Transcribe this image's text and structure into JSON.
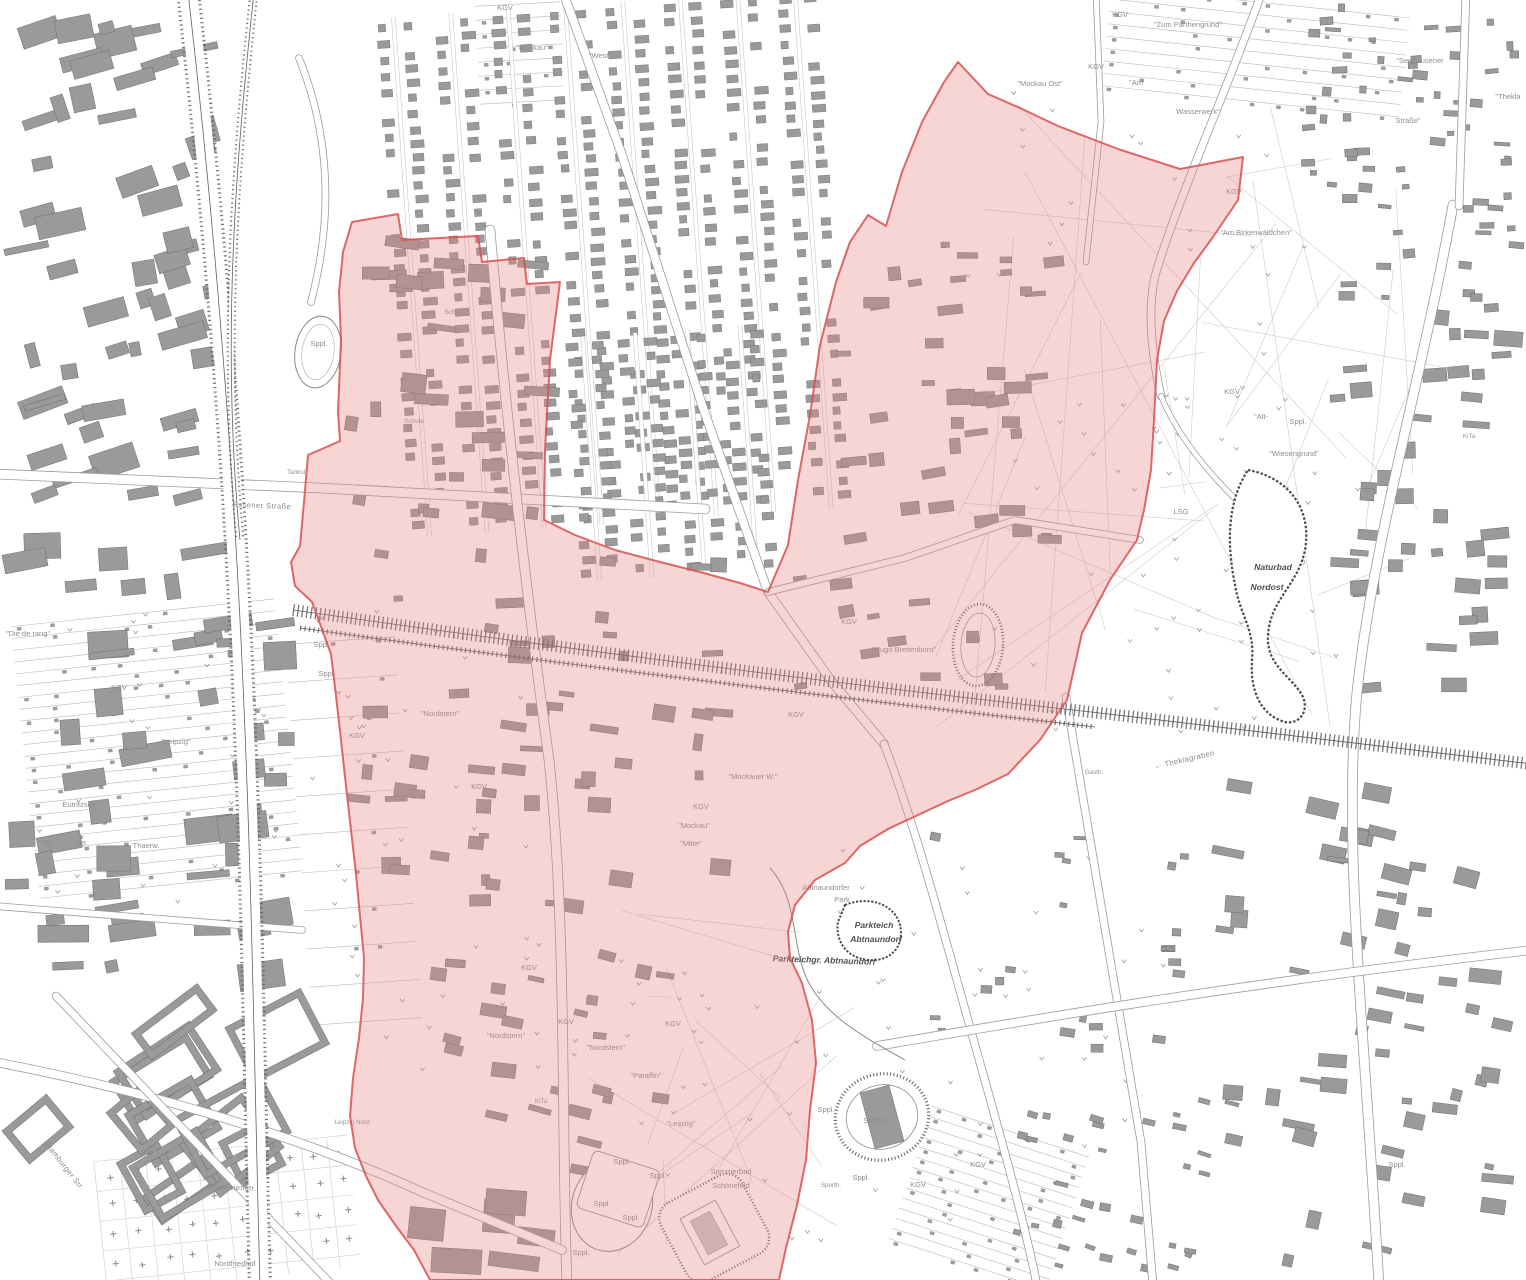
{
  "map": {
    "type": "cadastral-city-map-with-highlighted-district",
    "colors": {
      "background": "#ffffff",
      "building_fill": "#9a9a9a",
      "building_outline": "#6e6e6e",
      "road_casing": "#9c9c9c",
      "rail": "#5f5f5f",
      "water_outline": "#4c4c4c",
      "parcel_line": "#cccccc",
      "label_gray": "#8d8d8d",
      "label_dark": "#4f4f4f",
      "highlight_fill": "#e98585",
      "highlight_fill_opacity": "0.34",
      "highlight_stroke": "#d94f4f"
    },
    "labels": [
      {
        "t": "KGV",
        "x": 505,
        "y": 10
      },
      {
        "t": "\"Mockau\"",
        "x": 532,
        "y": 50
      },
      {
        "t": "\"West\"",
        "x": 600,
        "y": 58
      },
      {
        "t": "KGV",
        "x": 1120,
        "y": 17
      },
      {
        "t": "\"Zum Parthengrund\"",
        "x": 1188,
        "y": 27
      },
      {
        "t": "\"Mockau Ost\"",
        "x": 1040,
        "y": 86
      },
      {
        "t": "KGV",
        "x": 1096,
        "y": 69
      },
      {
        "t": "\"Am",
        "x": 1136,
        "y": 85
      },
      {
        "t": "Wasserwerk\"",
        "x": 1198,
        "y": 114
      },
      {
        "t": "\"Seehausener",
        "x": 1420,
        "y": 63
      },
      {
        "t": "Straße\"",
        "x": 1408,
        "y": 123
      },
      {
        "t": "\"Thekla",
        "x": 1508,
        "y": 99
      },
      {
        "t": "KGV",
        "x": 1234,
        "y": 194
      },
      {
        "t": "\"Am Birkenwäldchen\"",
        "x": 1256,
        "y": 235
      },
      {
        "t": "KGV",
        "x": 1232,
        "y": 394
      },
      {
        "t": "\"Alt-",
        "x": 1261,
        "y": 419
      },
      {
        "t": "Sppl.",
        "x": 1298,
        "y": 424
      },
      {
        "t": "\"Wiesengrund\"",
        "x": 1294,
        "y": 456
      },
      {
        "t": "LSG",
        "x": 1181,
        "y": 514
      },
      {
        "t": "KiTa",
        "x": 1469,
        "y": 438,
        "c": "tiny"
      },
      {
        "t": "Naturbad",
        "x": 1273,
        "y": 570,
        "c": "bold"
      },
      {
        "t": "Nordost",
        "x": 1267,
        "y": 590,
        "c": "bold"
      },
      {
        "t": "Essener Straße",
        "x": 262,
        "y": 508,
        "c": "street",
        "r": 2
      },
      {
        "t": "KGV",
        "x": 849,
        "y": 624
      },
      {
        "t": "\"Hugo Breitenborn\"",
        "x": 904,
        "y": 652
      },
      {
        "t": "Sppl.",
        "x": 974,
        "y": 641
      },
      {
        "t": "← Theklagraben",
        "x": 1185,
        "y": 762,
        "c": "street",
        "r": -13
      },
      {
        "t": "Gasth.",
        "x": 1094,
        "y": 774,
        "c": "tiny"
      },
      {
        "t": "Abtnaundorfer",
        "x": 826,
        "y": 890
      },
      {
        "t": "Park",
        "x": 842,
        "y": 902
      },
      {
        "t": "Parkteich",
        "x": 874,
        "y": 928,
        "c": "bold"
      },
      {
        "t": "Abtnaundorf",
        "x": 876,
        "y": 942,
        "c": "bold"
      },
      {
        "t": "Parkteichgr. Abtnaundorf",
        "x": 824,
        "y": 963,
        "c": "bold",
        "r": 2
      },
      {
        "t": "Stadion",
        "x": 876,
        "y": 1123
      },
      {
        "t": "Sppl.",
        "x": 826,
        "y": 1112
      },
      {
        "t": "Sporth.",
        "x": 831,
        "y": 1187,
        "c": "tiny"
      },
      {
        "t": "Sppl.",
        "x": 861,
        "y": 1180
      },
      {
        "t": "KGV",
        "x": 918,
        "y": 1187
      },
      {
        "t": "KGV",
        "x": 978,
        "y": 1167
      },
      {
        "t": "Sommerbad",
        "x": 731,
        "y": 1174
      },
      {
        "t": "Schönefeld",
        "x": 731,
        "y": 1188
      },
      {
        "t": "Sppl.",
        "x": 622,
        "y": 1164
      },
      {
        "t": "Sppl.",
        "x": 658,
        "y": 1178
      },
      {
        "t": "Sppl.",
        "x": 602,
        "y": 1206
      },
      {
        "t": "Sppl.",
        "x": 631,
        "y": 1220
      },
      {
        "t": "Sppl.",
        "x": 581,
        "y": 1255
      },
      {
        "t": "Sppl.",
        "x": 319,
        "y": 346
      },
      {
        "t": "Schule",
        "x": 454,
        "y": 314,
        "c": "tiny"
      },
      {
        "t": "Schule",
        "x": 414,
        "y": 423,
        "c": "tiny"
      },
      {
        "t": "Tankst.",
        "x": 297,
        "y": 474,
        "c": "tiny"
      },
      {
        "t": "Sppl.",
        "x": 322,
        "y": 647
      },
      {
        "t": "Sppl.",
        "x": 327,
        "y": 676
      },
      {
        "t": "KGV",
        "x": 357,
        "y": 738
      },
      {
        "t": "\"Nordstern\"",
        "x": 440,
        "y": 716
      },
      {
        "t": "KGV",
        "x": 479,
        "y": 789
      },
      {
        "t": "KGV",
        "x": 796,
        "y": 717
      },
      {
        "t": "\"Mockauer W.\"",
        "x": 753,
        "y": 779
      },
      {
        "t": "KGV",
        "x": 701,
        "y": 809
      },
      {
        "t": "\"Mockau\"",
        "x": 694,
        "y": 828
      },
      {
        "t": "\"Mitte\"",
        "x": 691,
        "y": 846
      },
      {
        "t": "KGV",
        "x": 529,
        "y": 970
      },
      {
        "t": "KGV",
        "x": 566,
        "y": 1024
      },
      {
        "t": "KGV",
        "x": 673,
        "y": 1026
      },
      {
        "t": "\"Nordstern\"",
        "x": 506,
        "y": 1038
      },
      {
        "t": "\"Nordstern\"",
        "x": 606,
        "y": 1050
      },
      {
        "t": "\"Paraffin\"",
        "x": 646,
        "y": 1078
      },
      {
        "t": "\"Leipzig\"",
        "x": 681,
        "y": 1126
      },
      {
        "t": "KiTa",
        "x": 541,
        "y": 1103,
        "c": "tiny"
      },
      {
        "t": "Leipzig Nord",
        "x": 352,
        "y": 1124,
        "c": "tiny"
      },
      {
        "t": "\"Die de rang\"",
        "x": 28,
        "y": 636
      },
      {
        "t": "KGV",
        "x": 119,
        "y": 690
      },
      {
        "t": "\"Leipzig\"",
        "x": 176,
        "y": 744
      },
      {
        "t": "Eutritzsch",
        "x": 79,
        "y": 807
      },
      {
        "t": "An",
        "x": 48,
        "y": 845
      },
      {
        "t": "der",
        "x": 81,
        "y": 845
      },
      {
        "t": "Thaerw.",
        "x": 146,
        "y": 848
      },
      {
        "t": "Theresienstr.",
        "x": 232,
        "y": 1190,
        "c": "street",
        "r": 2
      },
      {
        "t": "Hamburger Str.",
        "x": 63,
        "y": 1168,
        "c": "street",
        "r": 52
      },
      {
        "t": "Nordfriedhof",
        "x": 235,
        "y": 1266
      },
      {
        "t": "Sppl.",
        "x": 1397,
        "y": 1167
      }
    ]
  }
}
